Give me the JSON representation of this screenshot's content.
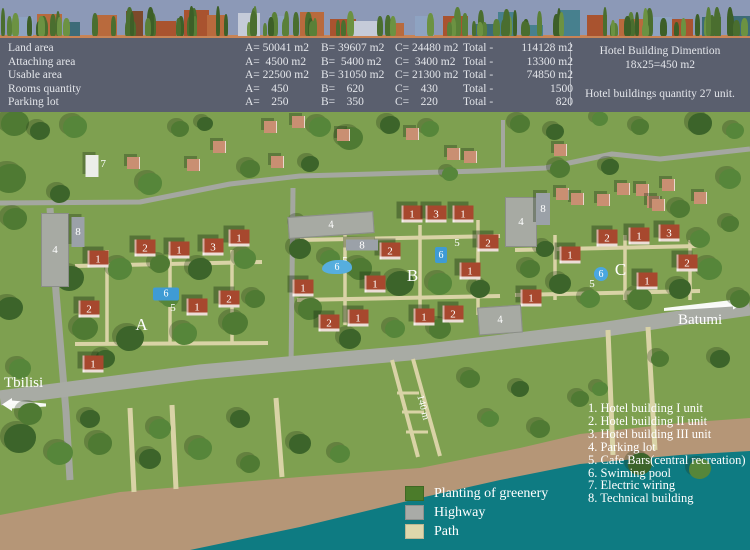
{
  "colors": {
    "sky": "#8c99b7",
    "table_bg": "#5a5f6e",
    "grass": "#7ea050",
    "sea": "#0e7b82",
    "beach": "#b59677",
    "road": "#a4a7a0",
    "road_main": "#a8aba4",
    "path": "#d9d3a6",
    "roof": "#a7482e",
    "pool": "#3f9bd4",
    "parking": "#a7aaa3"
  },
  "table": {
    "rows": [
      {
        "label": "Land area",
        "a": "A= 50041 m2",
        "b": "B= 39607 m2",
        "c": "C= 24480 m2",
        "total_label": "Total -",
        "total": "114128 m2"
      },
      {
        "label": "Attaching area",
        "a": "A=  4500 m2",
        "b": "B=  5400 m2",
        "c": "C=  3400 m2",
        "total_label": "Total -",
        "total": "13300 m2"
      },
      {
        "label": "Usable area",
        "a": "A= 22500 m2",
        "b": "B= 31050 m2",
        "c": "C= 21300 m2",
        "total_label": "Total -",
        "total": "74850 m2"
      },
      {
        "label": "Rooms quantity",
        "a": "A=    450",
        "b": "B=    620",
        "c": "C=    430",
        "total_label": "Total -",
        "total": "1500"
      },
      {
        "label": "Parking lot",
        "a": "A=    250",
        "b": "B=    350",
        "c": "C=    220",
        "total_label": "Total -",
        "total": "820"
      }
    ],
    "info": {
      "line1": "Hotel Building Dimention",
      "line2": "18x25=450 m2",
      "line3": "Hotel buildings quantity 27 unit."
    }
  },
  "map": {
    "cities": [
      {
        "name": "Tbilisi",
        "x": 4,
        "y": 263,
        "arrow": "left"
      },
      {
        "name": "Batumi",
        "x": 678,
        "y": 200,
        "arrow": "right"
      }
    ],
    "scale_label": "140 m",
    "markers": {
      "areas": [
        {
          "n": "A",
          "x": 142,
          "y": 213
        },
        {
          "n": "B",
          "x": 413,
          "y": 164
        },
        {
          "n": "C",
          "x": 621,
          "y": 158
        }
      ],
      "hotels": [
        {
          "n": "1",
          "x": 98,
          "y": 147
        },
        {
          "n": "2",
          "x": 145,
          "y": 136
        },
        {
          "n": "1",
          "x": 179,
          "y": 138
        },
        {
          "n": "3",
          "x": 213,
          "y": 135
        },
        {
          "n": "1",
          "x": 239,
          "y": 126
        },
        {
          "n": "2",
          "x": 89,
          "y": 197
        },
        {
          "n": "1",
          "x": 197,
          "y": 195
        },
        {
          "n": "2",
          "x": 229,
          "y": 187
        },
        {
          "n": "1",
          "x": 93,
          "y": 252
        },
        {
          "n": "1",
          "x": 412,
          "y": 102
        },
        {
          "n": "3",
          "x": 436,
          "y": 102
        },
        {
          "n": "1",
          "x": 463,
          "y": 102
        },
        {
          "n": "2",
          "x": 390,
          "y": 139
        },
        {
          "n": "2",
          "x": 488,
          "y": 131
        },
        {
          "n": "1",
          "x": 470,
          "y": 159
        },
        {
          "n": "1",
          "x": 375,
          "y": 172
        },
        {
          "n": "1",
          "x": 303,
          "y": 176
        },
        {
          "n": "2",
          "x": 329,
          "y": 211
        },
        {
          "n": "1",
          "x": 358,
          "y": 206
        },
        {
          "n": "1",
          "x": 424,
          "y": 205
        },
        {
          "n": "2",
          "x": 453,
          "y": 202
        },
        {
          "n": "2",
          "x": 607,
          "y": 126
        },
        {
          "n": "1",
          "x": 639,
          "y": 124
        },
        {
          "n": "3",
          "x": 669,
          "y": 121
        },
        {
          "n": "1",
          "x": 570,
          "y": 143
        },
        {
          "n": "2",
          "x": 687,
          "y": 151
        },
        {
          "n": "1",
          "x": 647,
          "y": 169
        },
        {
          "n": "1",
          "x": 531,
          "y": 186
        }
      ],
      "parkings": [
        {
          "n": "4",
          "x": 55,
          "y": 138,
          "w": 26,
          "h": 72,
          "r": 0
        },
        {
          "n": "4",
          "x": 331,
          "y": 113,
          "w": 84,
          "h": 20,
          "r": -4
        },
        {
          "n": "4",
          "x": 500,
          "y": 208,
          "w": 42,
          "h": 26,
          "r": -4
        },
        {
          "n": "4",
          "x": 521,
          "y": 110,
          "w": 30,
          "h": 48,
          "r": 0
        }
      ],
      "tech": [
        {
          "n": "8",
          "x": 78,
          "y": 120,
          "w": 13,
          "h": 30
        },
        {
          "n": "8",
          "x": 362,
          "y": 133,
          "w": 32,
          "h": 11
        },
        {
          "n": "8",
          "x": 543,
          "y": 97,
          "w": 14,
          "h": 32
        }
      ],
      "electric": [
        {
          "n": "7",
          "x": 92,
          "y": 54,
          "w": 13,
          "h": 22
        }
      ],
      "cafes": [
        {
          "n": "5",
          "x": 173,
          "y": 196
        },
        {
          "n": "5",
          "x": 345,
          "y": 149
        },
        {
          "n": "5",
          "x": 457,
          "y": 131
        },
        {
          "n": "5",
          "x": 592,
          "y": 172
        }
      ],
      "pools": [
        {
          "n": "6",
          "x": 166,
          "y": 182,
          "w": 26,
          "h": 13,
          "shape": "rect"
        },
        {
          "n": "6",
          "x": 337,
          "y": 155,
          "w": 30,
          "h": 14,
          "shape": "blob"
        },
        {
          "n": "6",
          "x": 441,
          "y": 143,
          "w": 12,
          "h": 16,
          "shape": "rect"
        },
        {
          "n": "6",
          "x": 601,
          "y": 162,
          "w": 14,
          "h": 14,
          "shape": "circle"
        }
      ]
    }
  },
  "legend": {
    "items": [
      "1. Hotel building I unit",
      "2. Hotel building II unit",
      "3. Hotel building III unit",
      "4. Parking lot",
      "5. Cafe Bars(central recreation)",
      "6. Swiming pool",
      "7. Electric wiring",
      "8. Technical building"
    ]
  },
  "color_legend": [
    {
      "label": "Planting of greenery",
      "color": "#4b7b2a"
    },
    {
      "label": "Highway",
      "color": "#a9aba7"
    },
    {
      "label": "Path",
      "color": "#ded7ac"
    }
  ]
}
